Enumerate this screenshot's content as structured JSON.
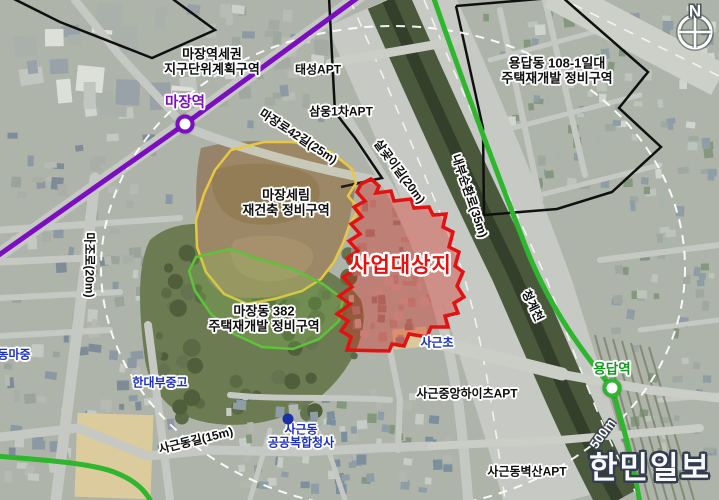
{
  "map": {
    "labels": [
      {
        "id": "jigudanwi-zone",
        "text": "마장역세권\n지구단위계획구역",
        "x": 212,
        "y": 62,
        "rot": 0,
        "cls": "lg"
      },
      {
        "id": "taeseong-apt",
        "text": "태성APT",
        "x": 318,
        "y": 70,
        "rot": 0,
        "cls": ""
      },
      {
        "id": "yongdap-zone",
        "text": "용답동 108-1일대\n주택재개발 정비구역",
        "x": 557,
        "y": 71,
        "rot": 0,
        "cls": "lg"
      },
      {
        "id": "majang-station",
        "text": "마장역",
        "x": 185,
        "y": 103,
        "rot": 0,
        "cls": "purple"
      },
      {
        "id": "majangro-42-gil",
        "text": "마장로42길(25m)",
        "x": 298,
        "y": 137,
        "rot": 33,
        "cls": ""
      },
      {
        "id": "samung-1cha-apt",
        "text": "삼웅1차APT",
        "x": 341,
        "y": 112,
        "rot": 0,
        "cls": ""
      },
      {
        "id": "salgoji-gil",
        "text": "살곶이길(20m)",
        "x": 399,
        "y": 172,
        "rot": 53,
        "cls": ""
      },
      {
        "id": "naebu-sunhwanro",
        "text": "내부순환로(35m)",
        "x": 469,
        "y": 196,
        "rot": 71,
        "cls": ""
      },
      {
        "id": "majang-serim-zone",
        "text": "마장세림\n재건축 정비구역",
        "x": 286,
        "y": 203,
        "rot": 0,
        "cls": "lg"
      },
      {
        "id": "majoro",
        "text": "마조로(20m)",
        "x": 89,
        "y": 265,
        "rot": 90,
        "cls": ""
      },
      {
        "id": "saeop-daesangji",
        "text": "사업대상지",
        "x": 401,
        "y": 266,
        "rot": 0,
        "cls": "red-big"
      },
      {
        "id": "majangdong-382-zone",
        "text": "마장동 382\n주택재개발 정비구역",
        "x": 264,
        "y": 319,
        "rot": 0,
        "cls": "lg"
      },
      {
        "id": "cheonggyecheon",
        "text": "청계천",
        "x": 532,
        "y": 306,
        "rot": 64,
        "cls": ""
      },
      {
        "id": "sageun-elementary",
        "text": "사근초",
        "x": 437,
        "y": 343,
        "rot": 0,
        "cls": "blue"
      },
      {
        "id": "dongma-middle",
        "text": "동마중",
        "x": 14,
        "y": 355,
        "rot": 0,
        "cls": "blue"
      },
      {
        "id": "handae-bu-school",
        "text": "한대부중고",
        "x": 160,
        "y": 383,
        "rot": 0,
        "cls": "blue"
      },
      {
        "id": "sageun-jungang-heights-apt",
        "text": "사근중앙하이츠APT",
        "x": 467,
        "y": 394,
        "rot": 0,
        "cls": ""
      },
      {
        "id": "yongdap-station",
        "text": "용답역",
        "x": 612,
        "y": 369,
        "rot": 0,
        "cls": "green"
      },
      {
        "id": "sageundong-gil",
        "text": "사근동길(15m)",
        "x": 196,
        "y": 441,
        "rot": -14,
        "cls": ""
      },
      {
        "id": "gonggong-cheongsa",
        "text": "사근동\n공공복합청사",
        "x": 301,
        "y": 437,
        "rot": 0,
        "cls": "blue"
      },
      {
        "id": "radius-500m",
        "text": "500m",
        "x": 603,
        "y": 434,
        "rot": -55,
        "cls": "white-out"
      },
      {
        "id": "sageun-byeoksan-apt",
        "text": "사근동벽산APT",
        "x": 527,
        "y": 472,
        "rot": 0,
        "cls": ""
      },
      {
        "id": "hanmin-ilbo-watermark",
        "text": "한민일보",
        "x": 650,
        "y": 469,
        "rot": 0,
        "cls": "watermark"
      },
      {
        "id": "compass-n",
        "text": "N",
        "x": 695,
        "y": 11,
        "rot": 0,
        "cls": "compass"
      }
    ],
    "stations": [
      {
        "id": "majang-station-marker",
        "x": 185,
        "y": 124,
        "color": "#7b0fc0"
      },
      {
        "id": "yongdap-station-marker",
        "x": 612,
        "y": 388,
        "color": "#2eb62e"
      }
    ],
    "markers": [
      {
        "id": "gonggong-cheongsa-dot",
        "x": 288,
        "y": 419,
        "color": "#1b2fa6"
      }
    ],
    "colors": {
      "subway_line_purple": "#7b0fc0",
      "subway_line_green": "#2eb62e",
      "site_boundary_red": "#e31212",
      "zone_boundary_yellow": "#e9c83f",
      "zone_boundary_green": "#5fc23a",
      "zone_boundary_black": "#101010",
      "radius_ring_white": "#ffffff"
    }
  }
}
